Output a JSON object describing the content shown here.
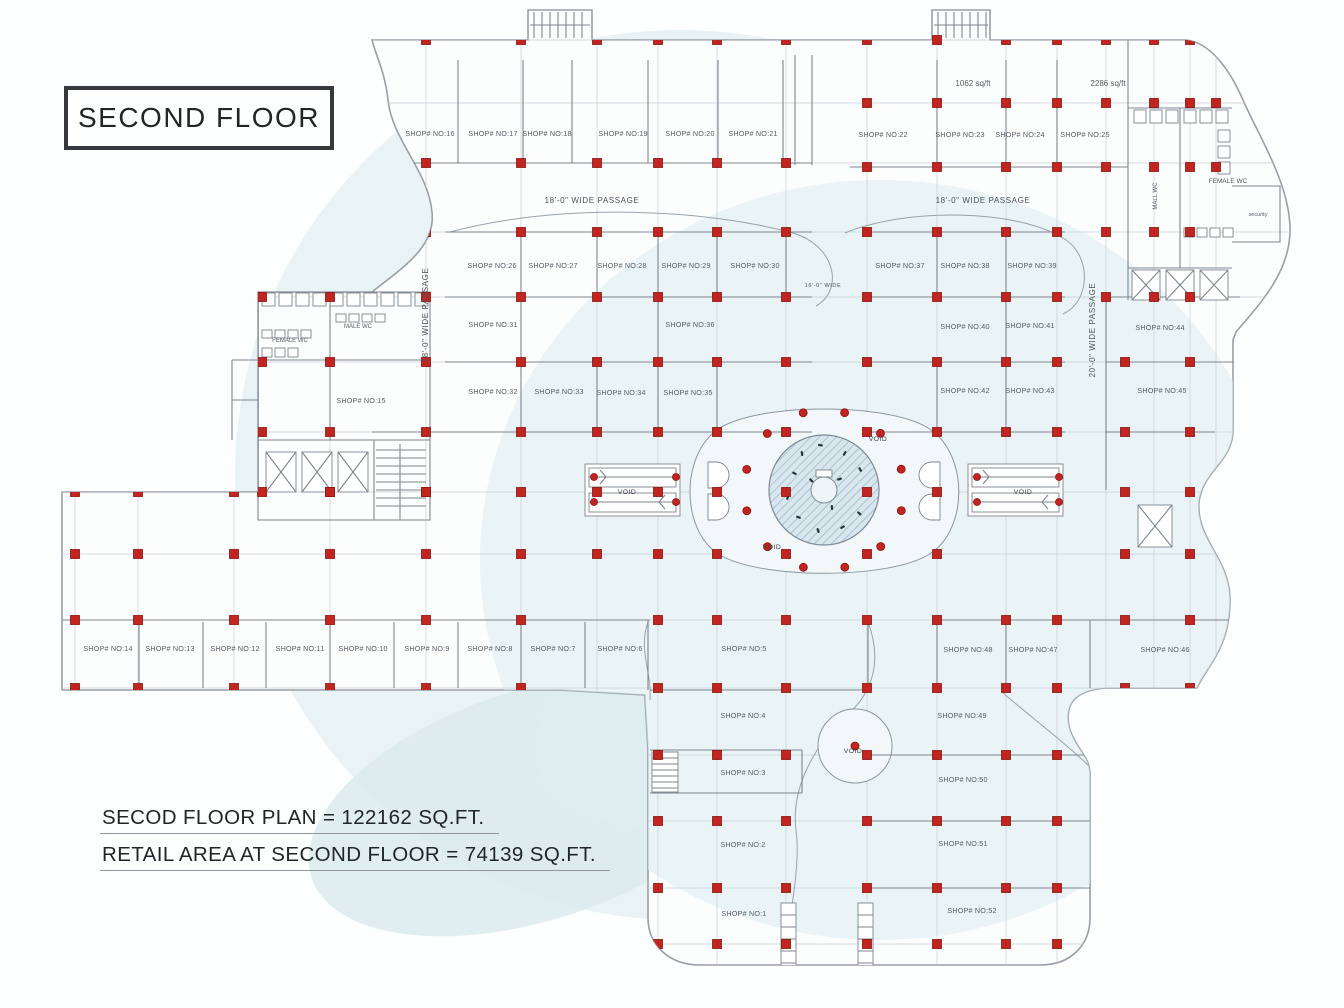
{
  "title": "SECOND FLOOR",
  "summary": {
    "line1": "SECOD FLOOR PLAN = 122162 SQ.FT.",
    "line2": "RETAIL AREA AT SECOND FLOOR = 74139 SQ.FT."
  },
  "colors": {
    "column_red": "#c1251f",
    "line_gray": "#7d868f",
    "watermark_blue": "#e9f2f4",
    "tint_blue": "#dfedf0"
  },
  "plan": {
    "shops": [
      {
        "t": "SHOP# NO:16",
        "x": 430,
        "y": 136
      },
      {
        "t": "SHOP# NO:17",
        "x": 493,
        "y": 136
      },
      {
        "t": "SHOP# NO:18",
        "x": 547,
        "y": 136
      },
      {
        "t": "SHOP# NO:19",
        "x": 623,
        "y": 136
      },
      {
        "t": "SHOP# NO:20",
        "x": 690,
        "y": 136
      },
      {
        "t": "SHOP# NO:21",
        "x": 753,
        "y": 136
      },
      {
        "t": "SHOP# NO:22",
        "x": 883,
        "y": 137
      },
      {
        "t": "SHOP# NO:23",
        "x": 960,
        "y": 137
      },
      {
        "t": "SHOP# NO:24",
        "x": 1020,
        "y": 137
      },
      {
        "t": "SHOP# NO:25",
        "x": 1085,
        "y": 137
      },
      {
        "t": "SHOP# NO:26",
        "x": 492,
        "y": 268
      },
      {
        "t": "SHOP# NO:27",
        "x": 553,
        "y": 268
      },
      {
        "t": "SHOP# NO:28",
        "x": 622,
        "y": 268
      },
      {
        "t": "SHOP# NO:29",
        "x": 686,
        "y": 268
      },
      {
        "t": "SHOP# NO:30",
        "x": 755,
        "y": 268
      },
      {
        "t": "SHOP# NO:37",
        "x": 900,
        "y": 268
      },
      {
        "t": "SHOP# NO:38",
        "x": 965,
        "y": 268
      },
      {
        "t": "SHOP# NO:39",
        "x": 1032,
        "y": 268
      },
      {
        "t": "SHOP# NO:31",
        "x": 493,
        "y": 327
      },
      {
        "t": "SHOP# NO:36",
        "x": 690,
        "y": 327
      },
      {
        "t": "SHOP# NO:40",
        "x": 965,
        "y": 329
      },
      {
        "t": "SHOP# NO:41",
        "x": 1030,
        "y": 328
      },
      {
        "t": "SHOP# NO:44",
        "x": 1160,
        "y": 330
      },
      {
        "t": "SHOP# NO:32",
        "x": 493,
        "y": 394
      },
      {
        "t": "SHOP# NO:33",
        "x": 559,
        "y": 394
      },
      {
        "t": "SHOP# NO:34",
        "x": 621,
        "y": 395
      },
      {
        "t": "SHOP# NO:35",
        "x": 688,
        "y": 395
      },
      {
        "t": "SHOP# NO:42",
        "x": 965,
        "y": 393
      },
      {
        "t": "SHOP# NO:43",
        "x": 1030,
        "y": 393
      },
      {
        "t": "SHOP# NO:45",
        "x": 1162,
        "y": 393
      },
      {
        "t": "SHOP# NO:15",
        "x": 361,
        "y": 403
      },
      {
        "t": "SHOP# NO:14",
        "x": 108,
        "y": 651
      },
      {
        "t": "SHOP# NO:13",
        "x": 170,
        "y": 651
      },
      {
        "t": "SHOP# NO:12",
        "x": 235,
        "y": 651
      },
      {
        "t": "SHOP# NO:11",
        "x": 300,
        "y": 651
      },
      {
        "t": "SHOP# NO:10",
        "x": 363,
        "y": 651
      },
      {
        "t": "SHOP# NO:9",
        "x": 427,
        "y": 651
      },
      {
        "t": "SHOP# NO:8",
        "x": 490,
        "y": 651
      },
      {
        "t": "SHOP# NO:7",
        "x": 553,
        "y": 651
      },
      {
        "t": "SHOP# NO:6",
        "x": 620,
        "y": 651
      },
      {
        "t": "SHOP# NO:5",
        "x": 744,
        "y": 651
      },
      {
        "t": "SHOP# NO:48",
        "x": 968,
        "y": 652
      },
      {
        "t": "SHOP# NO:47",
        "x": 1033,
        "y": 652
      },
      {
        "t": "SHOP# NO:46",
        "x": 1165,
        "y": 652
      },
      {
        "t": "SHOP# NO:4",
        "x": 743,
        "y": 718
      },
      {
        "t": "SHOP# NO:3",
        "x": 743,
        "y": 775
      },
      {
        "t": "SHOP# NO:2",
        "x": 743,
        "y": 847
      },
      {
        "t": "SHOP# NO:1",
        "x": 744,
        "y": 916
      },
      {
        "t": "SHOP# NO:49",
        "x": 962,
        "y": 718
      },
      {
        "t": "SHOP# NO:50",
        "x": 963,
        "y": 782
      },
      {
        "t": "SHOP# NO:51",
        "x": 963,
        "y": 846
      },
      {
        "t": "SHOP# NO:52",
        "x": 972,
        "y": 913
      }
    ],
    "area_labels": [
      {
        "t": "1062 sq/ft",
        "x": 973,
        "y": 86
      },
      {
        "t": "2286 sq/ft",
        "x": 1108,
        "y": 86
      }
    ],
    "passages": [
      {
        "t": "18'-0\" WIDE PASSAGE",
        "x": 592,
        "y": 203
      },
      {
        "t": "18'-0\" WIDE PASSAGE",
        "x": 983,
        "y": 203
      },
      {
        "t": "18'-0\" WIDE PASSAGE",
        "x": 428,
        "y": 315,
        "r": -90
      },
      {
        "t": "20'-0\" WIDE PASSAGE",
        "x": 1095,
        "y": 330,
        "r": -90
      },
      {
        "t": "16'-0\" WIDE",
        "x": 823,
        "y": 287,
        "s": 5.5
      }
    ],
    "voids": [
      {
        "t": "VOID",
        "x": 878,
        "y": 441
      },
      {
        "t": "VOID",
        "x": 772,
        "y": 549
      },
      {
        "t": "VOID",
        "x": 627,
        "y": 494
      },
      {
        "t": "VOID",
        "x": 1023,
        "y": 494
      },
      {
        "t": "VOID",
        "x": 853,
        "y": 753
      }
    ],
    "rooms": [
      {
        "t": "MALE WC",
        "x": 358,
        "y": 328,
        "s": 6
      },
      {
        "t": "FEMALE WC",
        "x": 290,
        "y": 342,
        "s": 6
      },
      {
        "t": "MALL WC",
        "x": 1157,
        "y": 196,
        "r": -90,
        "s": 6
      },
      {
        "t": "FEMALE WC",
        "x": 1228,
        "y": 183,
        "s": 6.5
      },
      {
        "t": "security",
        "x": 1258,
        "y": 216,
        "s": 5.5
      }
    ],
    "columns": {
      "zones": [
        {
          "xs": [
            426,
            521,
            597,
            658,
            717,
            786
          ],
          "ys": [
            40,
            163,
            232,
            297,
            362,
            432
          ]
        },
        {
          "xs": [
            867,
            937,
            1006,
            1057
          ],
          "ys": [
            40,
            103,
            167,
            232,
            297,
            362,
            432
          ]
        },
        {
          "xs": [
            262,
            330
          ],
          "ys": [
            297,
            362,
            432,
            492
          ]
        },
        {
          "xs": [
            426
          ],
          "ys": [
            492
          ]
        },
        {
          "xs": [
            75,
            138,
            234,
            330,
            426,
            521
          ],
          "ys": [
            492,
            554,
            620,
            688
          ]
        },
        {
          "xs": [
            597,
            658,
            717,
            786,
            867,
            937
          ],
          "ys": [
            492,
            554
          ]
        },
        {
          "xs": [
            658,
            717,
            786,
            867,
            937,
            1006,
            1057
          ],
          "ys": [
            620,
            688,
            755,
            821,
            888,
            944
          ]
        },
        {
          "xs": [
            1106,
            1154,
            1190
          ],
          "ys": [
            40,
            103,
            167,
            232,
            297
          ]
        },
        {
          "xs": [
            1125,
            1190
          ],
          "ys": [
            362,
            432,
            492,
            554,
            620,
            688
          ]
        },
        {
          "xs": [
            1216
          ],
          "ys": [
            103,
            167
          ]
        }
      ],
      "ring": {
        "cx": 824,
        "cy": 490,
        "r": 80,
        "n": 12
      }
    }
  }
}
